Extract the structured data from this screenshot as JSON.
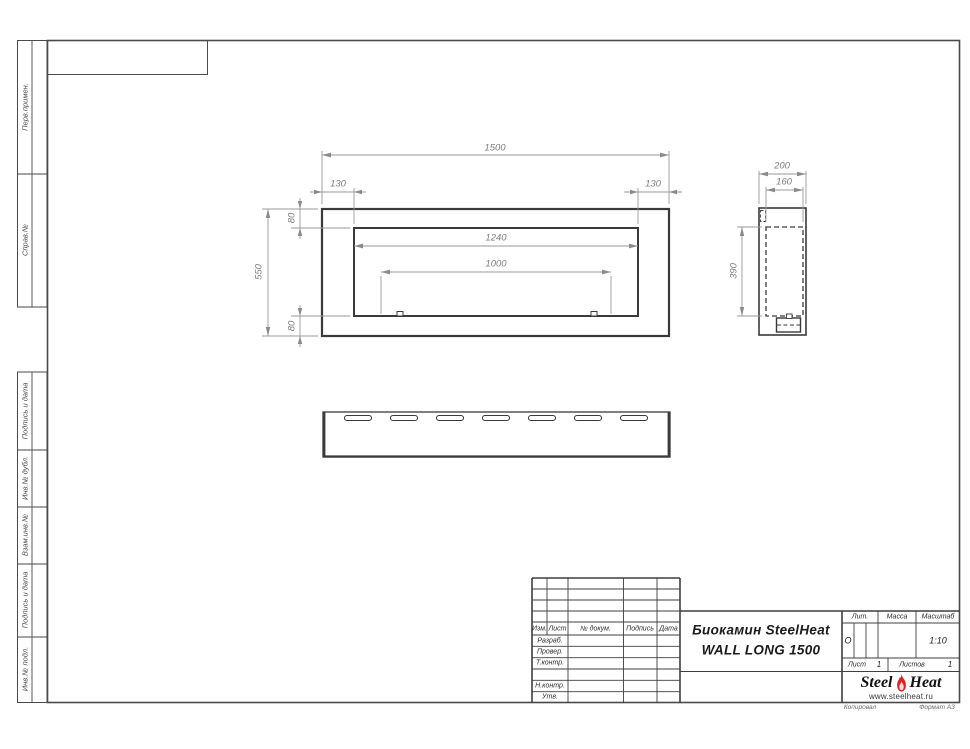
{
  "margin_labels": {
    "perv": "Перв.примен.",
    "sprav": "Справ.№",
    "podpis1": "Подпись и дата",
    "inv_dubl": "Инв.№ дубл.",
    "vzam": "Взам.инв.№",
    "podpis2": "Подпись и дата",
    "inv_podl": "Инв.№ подл."
  },
  "dims": {
    "d1500": "1500",
    "d130l": "130",
    "d130r": "130",
    "d80t": "80",
    "d550": "550",
    "d80b": "80",
    "d1240": "1240",
    "d1000": "1000",
    "d200": "200",
    "d160": "160",
    "d390": "390"
  },
  "title_block": {
    "header_cols": {
      "izm": "Изм.",
      "list": "Лист",
      "doc": "№ докум.",
      "podpis": "Подпись",
      "data": "Дата"
    },
    "rows": {
      "razrab": "Разраб.",
      "prover": "Провер.",
      "tkontr": "Т.контр.",
      "nkontr": "Н.контр.",
      "utv": "Утв."
    },
    "title_line1": "Биокамин SteelHeat",
    "title_line2": "WALL LONG 1500",
    "lit_label": "Лит.",
    "lit_value": "О",
    "massa_label": "Масса",
    "scale_label": "Масштаб",
    "scale_value": "1:10",
    "sheet_label": "Лист",
    "sheet_value": "1",
    "sheets_label": "Листов",
    "sheets_value": "1",
    "logo": {
      "steel": "Steel",
      "heat": "Heat",
      "site": "www.steelheat.ru",
      "flame_color": "#e31e24"
    }
  },
  "footer": {
    "copied": "Копировал",
    "format": "Формат А3"
  }
}
